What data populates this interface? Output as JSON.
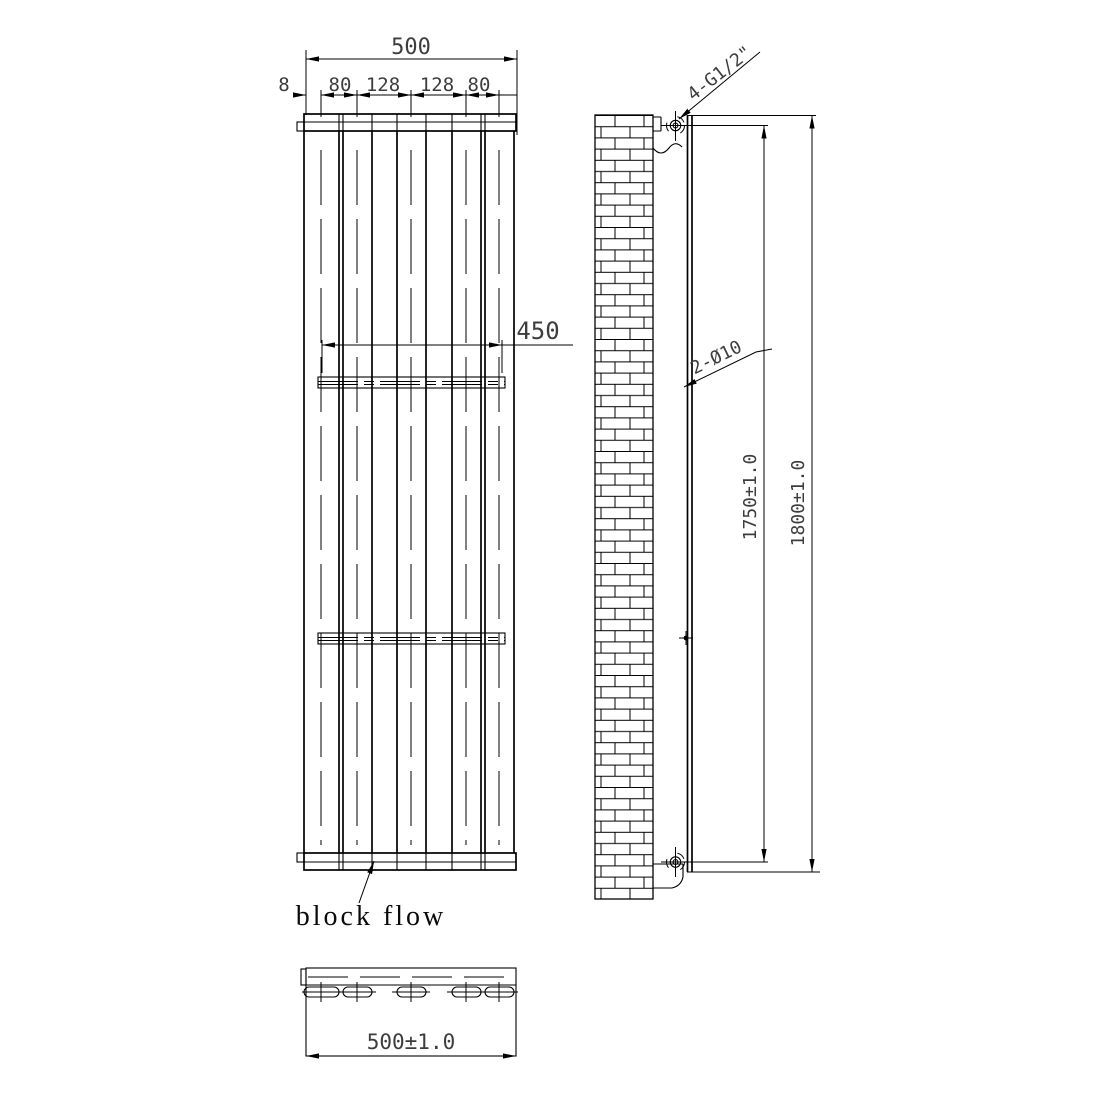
{
  "drawing": {
    "title": "vertical-radiator-technical-drawing",
    "front_view": {
      "dim_overall_width": "500",
      "dim_left_offset": "8",
      "dim_spacings": [
        "80",
        "128",
        "128",
        "80"
      ],
      "dim_bracket_span": "450",
      "block_flow_label": "block flow"
    },
    "side_view": {
      "connection_label": "4-G1/2\"",
      "hole_label": "2-Ø10",
      "dim_port_distance": "1750±1.0",
      "dim_overall_height": "1800±1.0"
    },
    "bottom_view": {
      "dim_overall_width": "500±1.0"
    },
    "colors": {
      "line": "#000000",
      "dim_text": "#3d3d3d",
      "background": "#ffffff"
    }
  }
}
